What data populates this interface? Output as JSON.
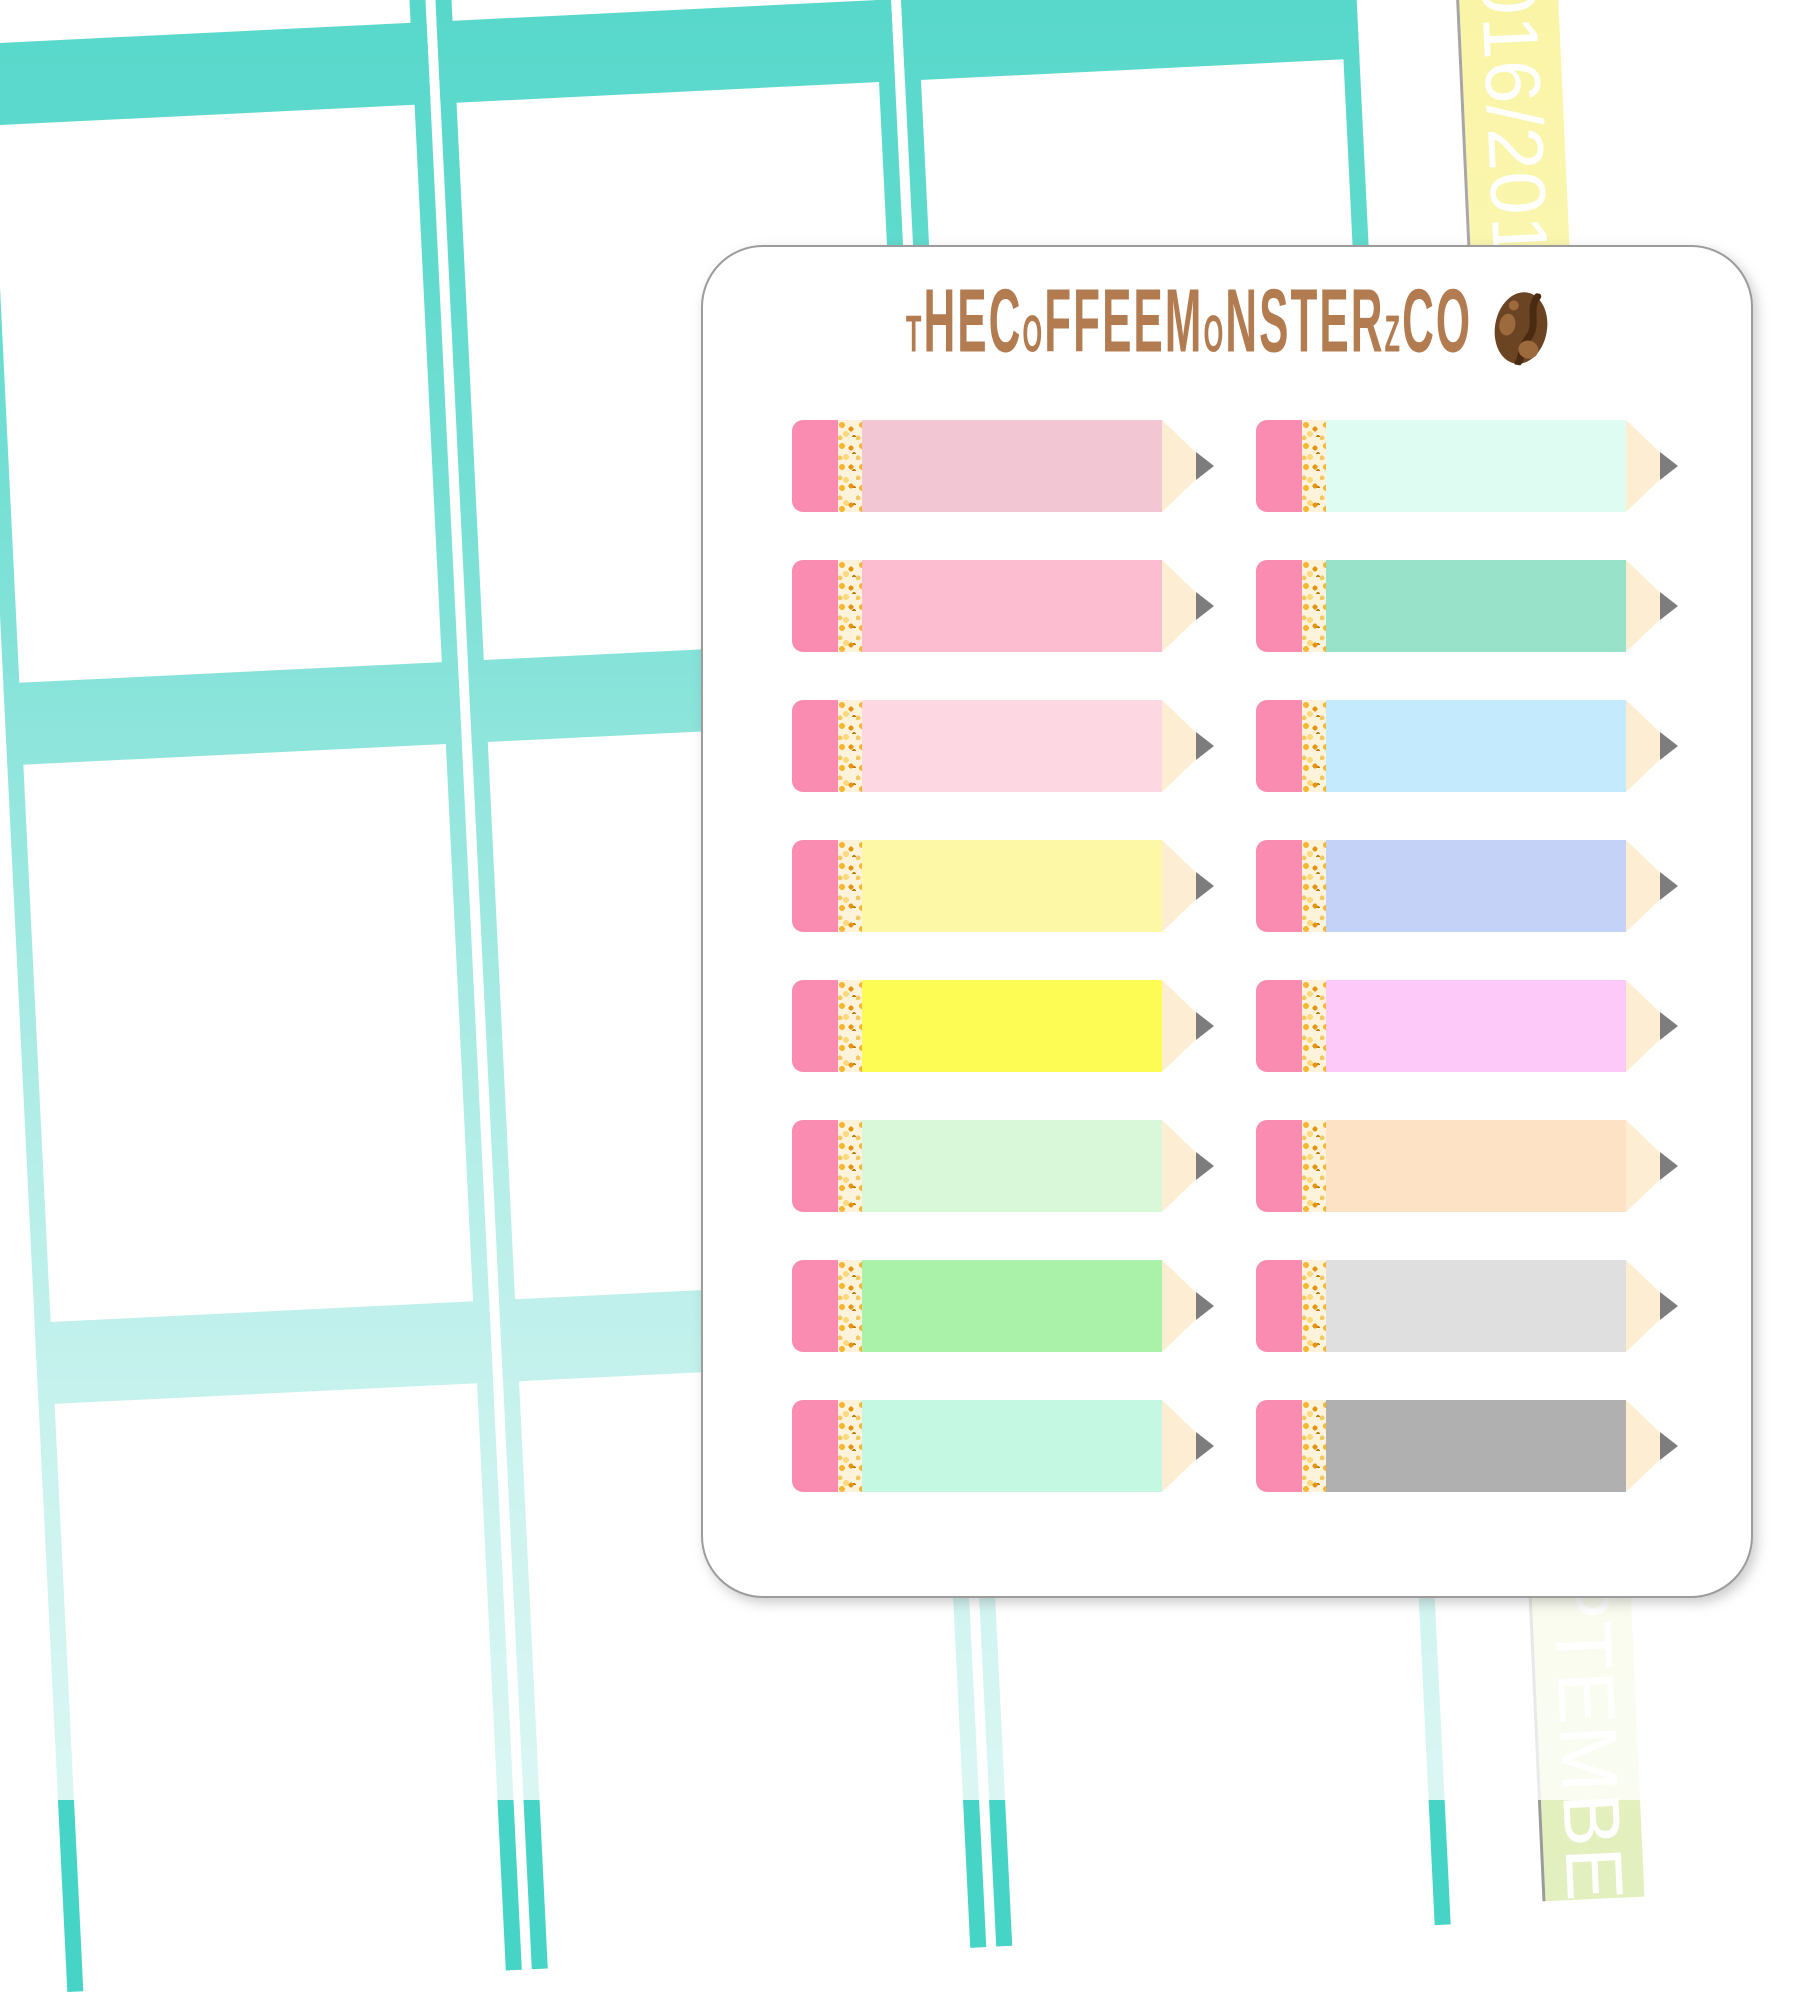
{
  "brand": {
    "name": "tHECoFFEEMoNSTERzCO",
    "logo_icon": "coffee-bean-icon"
  },
  "washi_strip": {
    "top_text": "2016/2017",
    "top_text_visible": "2016/2",
    "bottom_text": "SEPTEMBER",
    "bottom_text_visible": "TEMB"
  },
  "sheet": {
    "description": "white sticker sheet with rounded corners",
    "rows": 8,
    "columns": 2,
    "total_stickers": 16
  },
  "stickers": {
    "left_column": [
      {
        "name": "dusty-pink-pencil",
        "hex": "#f2c6d3"
      },
      {
        "name": "pink-pencil",
        "hex": "#fdbdd1"
      },
      {
        "name": "light-pink-pencil",
        "hex": "#fdd8e3"
      },
      {
        "name": "pale-yellow-pencil",
        "hex": "#fcf8a6"
      },
      {
        "name": "yellow-pencil",
        "hex": "#fdfc55"
      },
      {
        "name": "pale-green-pencil",
        "hex": "#d9f8da"
      },
      {
        "name": "light-green-pencil",
        "hex": "#aaf2aa"
      },
      {
        "name": "mint-pencil",
        "hex": "#c4f8e2"
      }
    ],
    "right_column": [
      {
        "name": "pale-mint-pencil",
        "hex": "#dffcf3"
      },
      {
        "name": "seafoam-pencil",
        "hex": "#97e2c9"
      },
      {
        "name": "light-blue-pencil",
        "hex": "#c3ebfd"
      },
      {
        "name": "periwinkle-pencil",
        "hex": "#c4d2f8"
      },
      {
        "name": "orchid-pencil",
        "hex": "#fdc9f8"
      },
      {
        "name": "peach-pencil",
        "hex": "#fde2c6"
      },
      {
        "name": "light-gray-pencil",
        "hex": "#dfdfdf"
      },
      {
        "name": "gray-pencil",
        "hex": "#b0b0b0"
      }
    ]
  },
  "colors": {
    "teal": "#45d4c5",
    "strip_yellow_top": "#faf49b",
    "strip_yellow_bottom": "#e2efbe",
    "page_edge_gray": "#9b9b9b",
    "sheet_border_gray": "#9c9c9c",
    "eraser_pink": "#f98cb0",
    "ferrule_gold": "#f0a93a",
    "tip_cream": "#fdeed3",
    "point_gray": "#7d7d7d",
    "brand_brown": "#b27c50",
    "bean_brown": "#6b4423",
    "bean_groove": "#4a2b11",
    "bean_spot": "#9c6a3c"
  }
}
